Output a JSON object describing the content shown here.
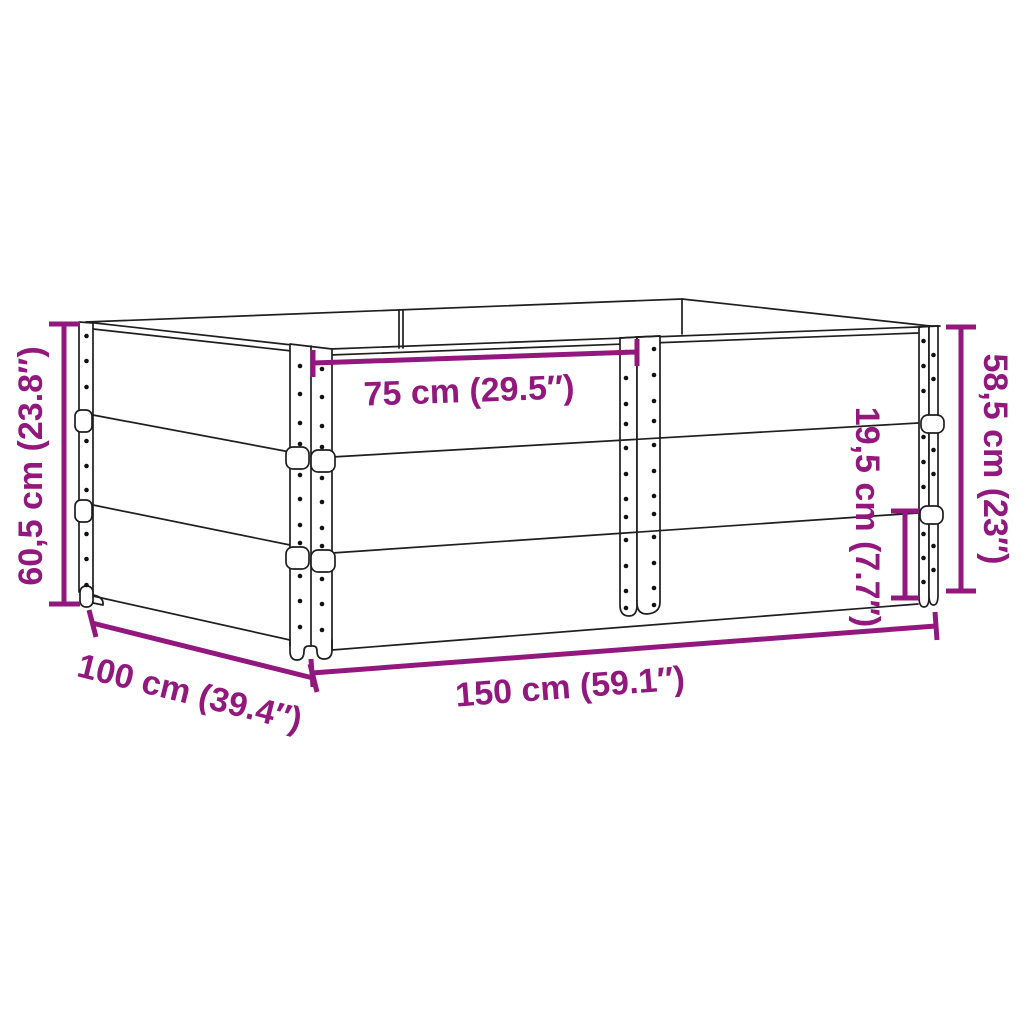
{
  "dimensions": {
    "total_height": "60,5 cm (23.8″)",
    "half_length": "75 cm (29.5″)",
    "collar_height": "19,5 cm (7.7″)",
    "upper_stack_height": "58,5 cm (23″)",
    "depth": "100 cm (39.4″)",
    "length": "150 cm (59.1″)"
  },
  "colors": {
    "dimension_accent": "#92187E",
    "line_art": "#1e1e1e",
    "background": "#ffffff"
  }
}
